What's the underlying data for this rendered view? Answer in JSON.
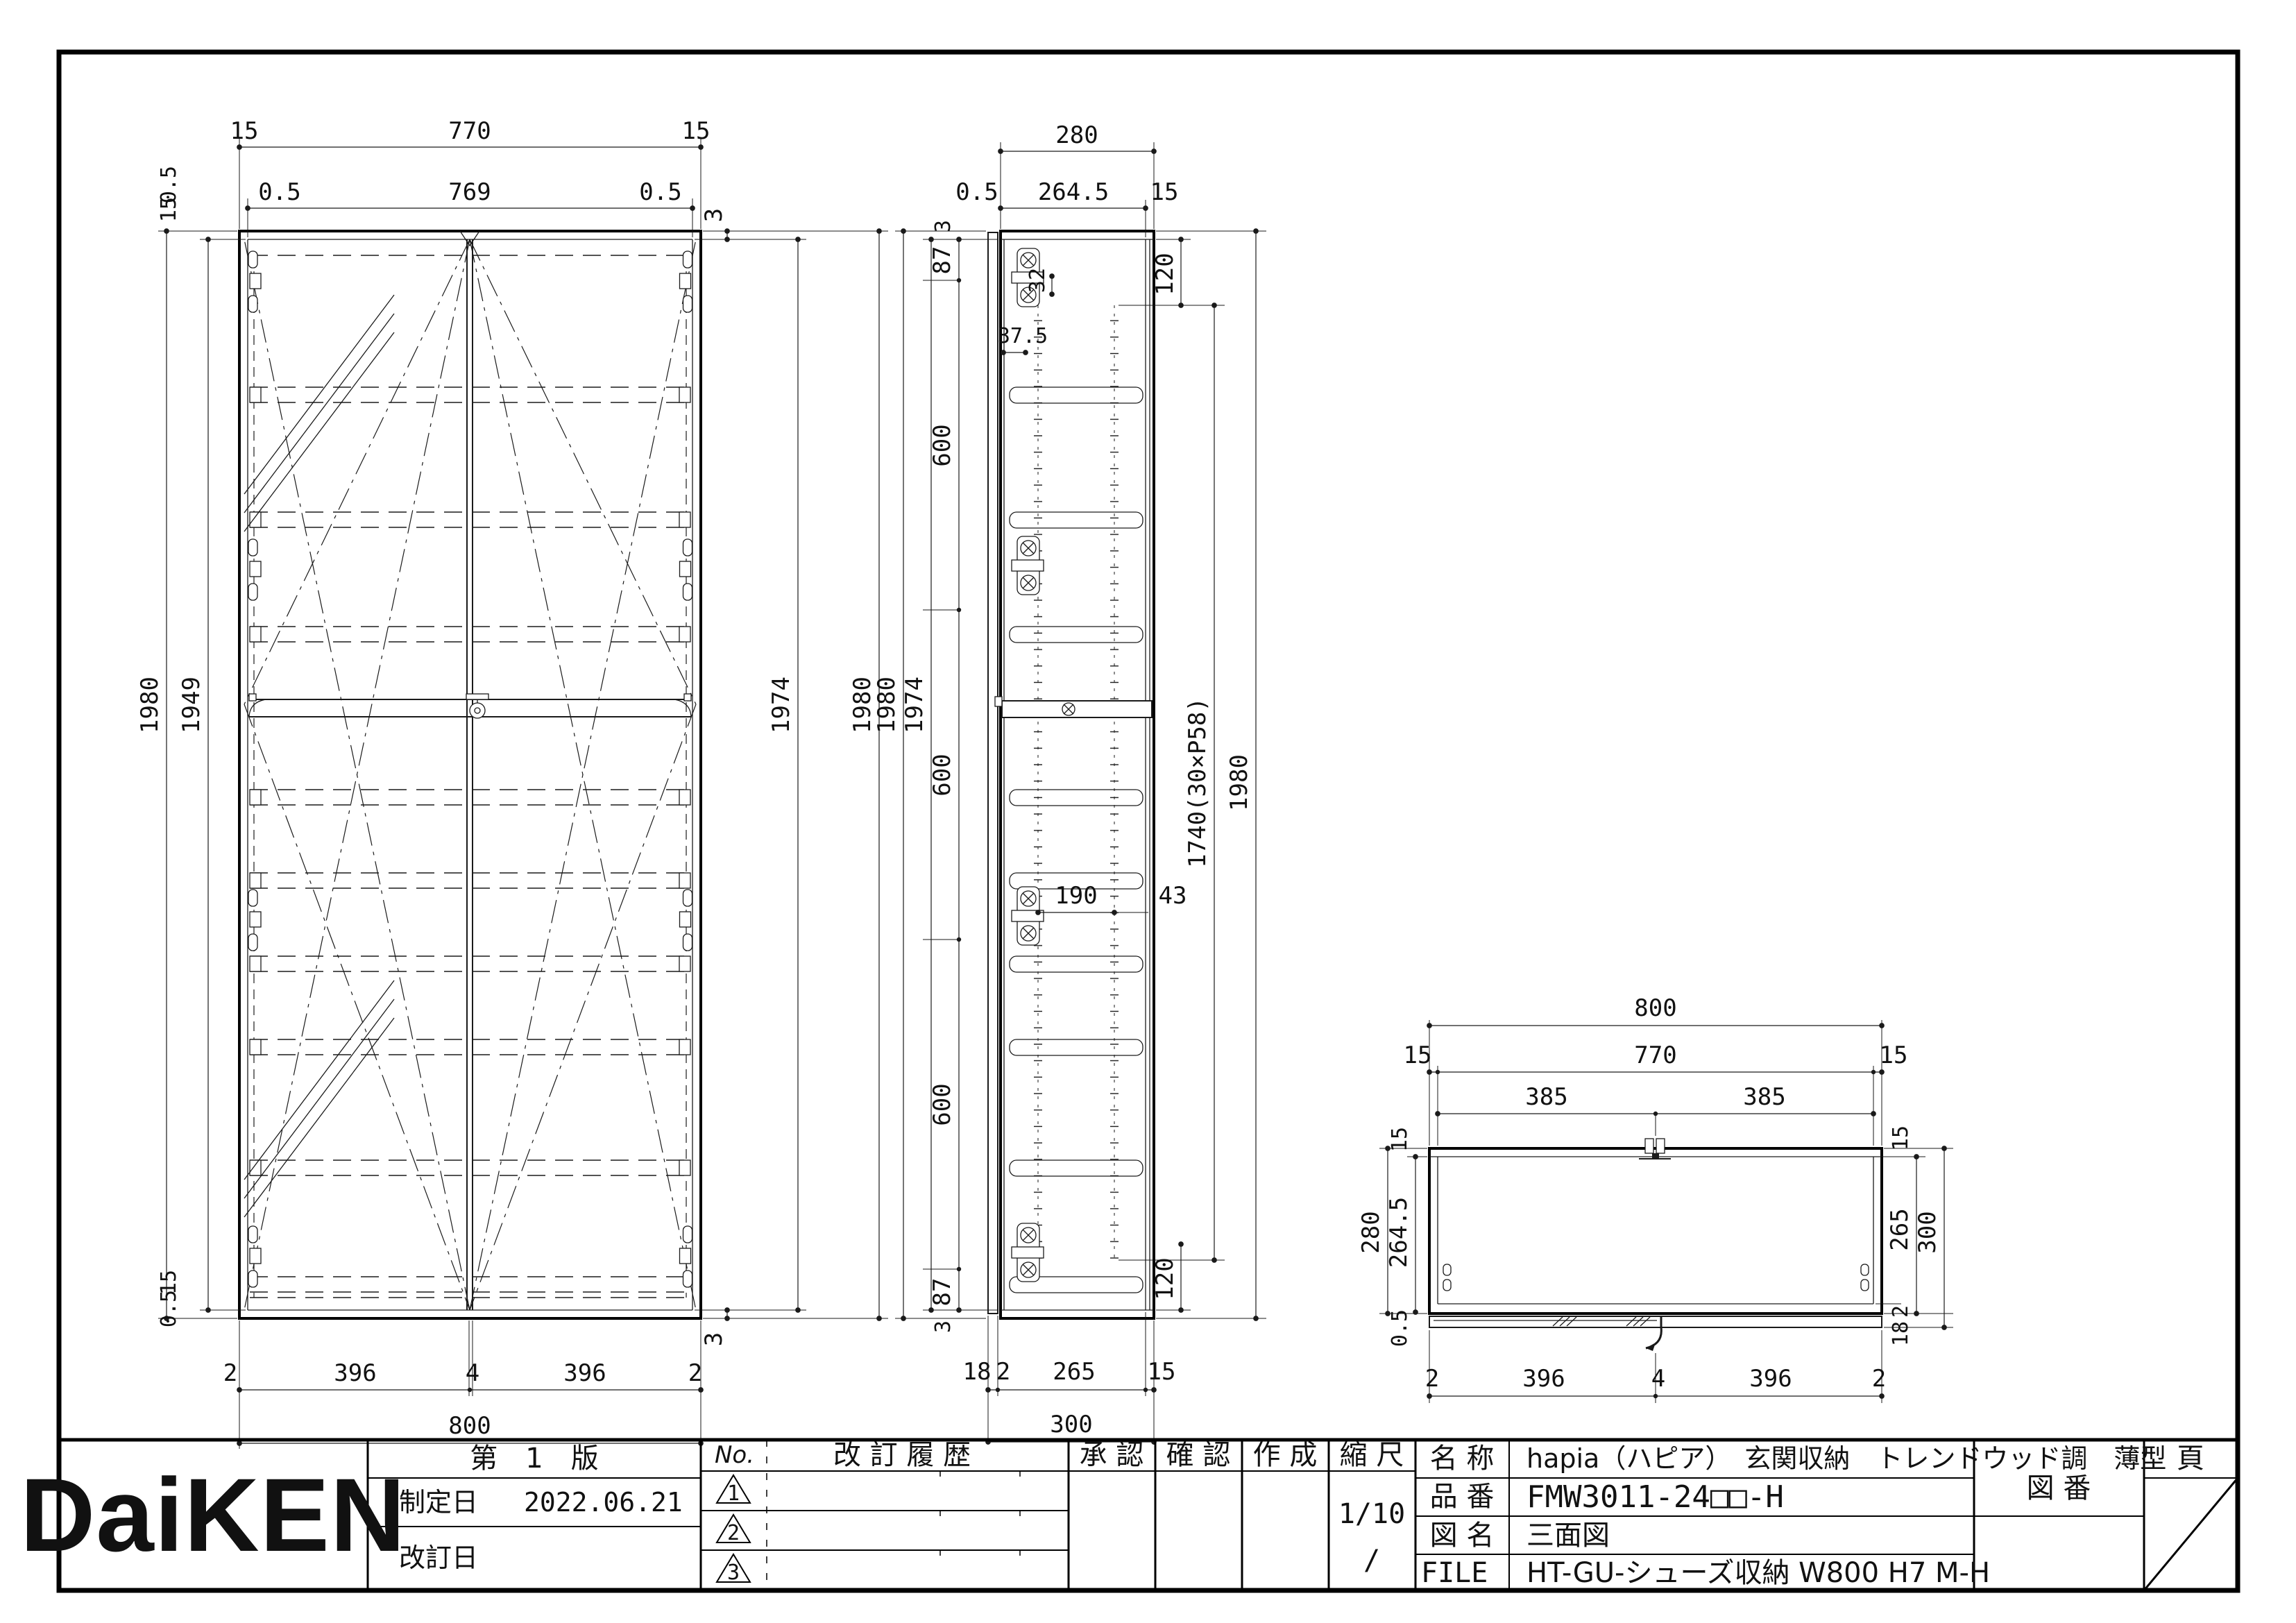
{
  "sheet": {
    "bg": "#ffffff",
    "line_color": "#1a1a1a"
  },
  "front": {
    "top1": [
      "15",
      "770",
      "15"
    ],
    "top2": [
      "0.5",
      "769",
      "0.5"
    ],
    "right_gap_top": "3",
    "right_gap_bottom": "3",
    "left_outer": "1980",
    "left_inner": "1949",
    "left_top_offsets": [
      "0.5",
      "15"
    ],
    "left_bottom_offsets": [
      "15",
      "0.5"
    ],
    "right_inner": "1974",
    "right_outer": "1980",
    "bottom1": [
      "2",
      "396",
      "4",
      "396",
      "2"
    ],
    "bottom_total": "800"
  },
  "side": {
    "top_total": "280",
    "top2": [
      "0.5",
      "264.5",
      "15"
    ],
    "left_stack": [
      "3",
      "87",
      "600",
      "600",
      "600",
      "87",
      "3"
    ],
    "left_inner": "1974",
    "left_outer": "1980",
    "hinge_pitch": "32",
    "hinge_offset": "37.5",
    "hole_span": "190",
    "hole_back": "43",
    "right_top": "120",
    "right_span": "1740(30×P58)",
    "right_outer": "1980",
    "right_bottom": "120",
    "bottom1": [
      "18",
      "2",
      "265",
      "15"
    ],
    "bottom_total": "300"
  },
  "plan": {
    "top_total": "800",
    "top2": [
      "15",
      "770",
      "15"
    ],
    "top3": [
      "385",
      "385"
    ],
    "left_outer": "280",
    "left_inner": "264.5",
    "left_top": "15",
    "left_bottom": "0.5",
    "right_top": "15",
    "right_inner": "265",
    "right_outer": "300",
    "right_gap": "2",
    "right_door": "18",
    "bottom": [
      "2",
      "396",
      "4",
      "396",
      "2"
    ]
  },
  "title_block": {
    "logo": "DaiKEN",
    "edition": "第　1　版",
    "established_label": "制定日",
    "established_date": "2022.06.21",
    "revised_label": "改訂日",
    "no_label": "No.",
    "history_label": "改 訂 履 歴",
    "rev_marks": [
      "1",
      "2",
      "3"
    ],
    "approval_label": "承 認",
    "check_label": "確 認",
    "create_label": "作 成",
    "scale_label": "縮 尺",
    "scale_value": "1/10",
    "scale_value2": "/",
    "name_label": "名 称",
    "name_value": "hapia（ハピア）　玄関収納　トレンドウッド調　薄型",
    "part_label": "品 番",
    "part_value": "FMW3011-24□□-H",
    "figure_label": "図 名",
    "figure_value": "三面図",
    "file_label": "FILE",
    "file_value": "HT-GU-シューズ収納 W800 H7 M-H",
    "drawing_no_label": "図 番",
    "page_label": "頁"
  }
}
